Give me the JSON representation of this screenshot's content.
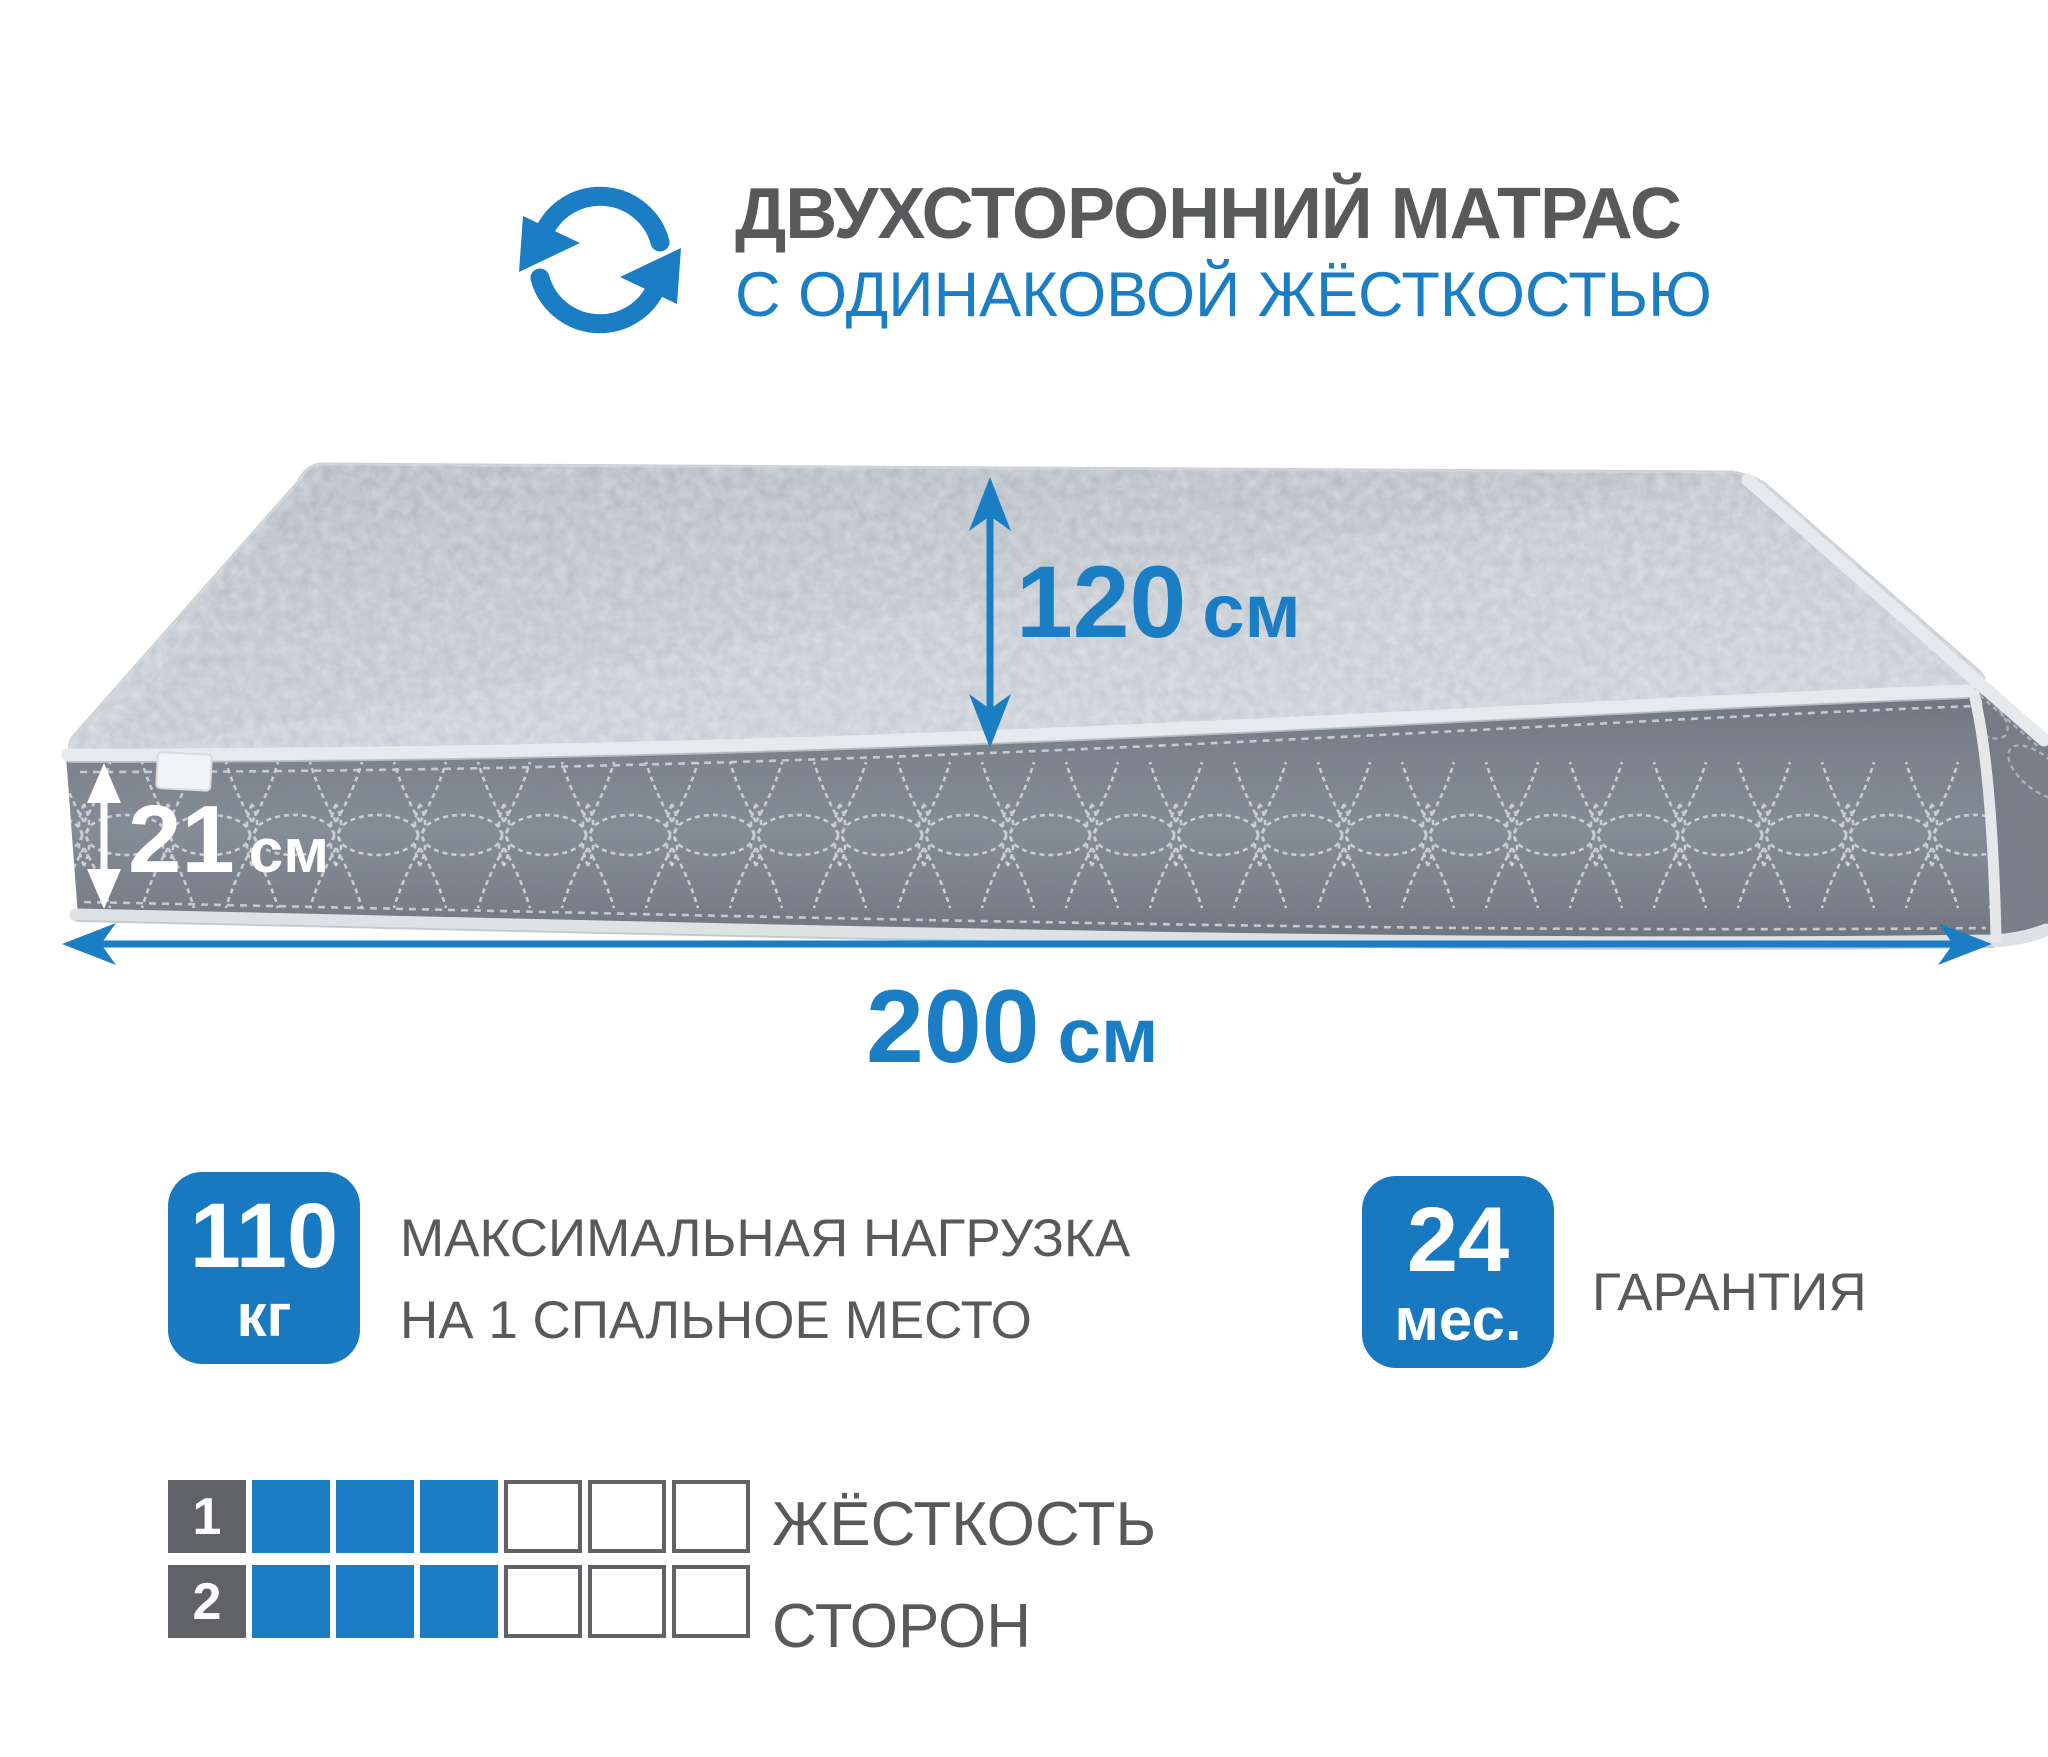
{
  "header": {
    "title_line1": "ДВУХСТОРОННИЙ МАТРАС",
    "title_line2": "С ОДИНАКОВОЙ ЖЁСТКОСТЬЮ",
    "icon": "rotate-arrows-icon"
  },
  "mattress": {
    "depth": {
      "value": "120",
      "unit": "см"
    },
    "thickness": {
      "value": "21",
      "unit": "см"
    },
    "length": {
      "value": "200",
      "unit": "см"
    }
  },
  "features": {
    "max_load": {
      "value": "110",
      "unit": "кг",
      "label_line1": "МАКСИМАЛЬНАЯ НАГРУЗКА",
      "label_line2": "НА 1 СПАЛЬНОЕ МЕСТО"
    },
    "warranty": {
      "value": "24",
      "unit": "мес.",
      "label": "ГАРАНТИЯ"
    }
  },
  "hardness": {
    "label_line1": "ЖЁСТКОСТЬ",
    "label_line2": "СТОРОН",
    "scale_max": 6,
    "rows": [
      {
        "side_number": "1",
        "filled": 3
      },
      {
        "side_number": "2",
        "filled": 3
      }
    ]
  },
  "colors": {
    "accent_blue": "#1b7ec5",
    "badge_blue": "#1878c0",
    "text_gray": "#58595b",
    "tile_gray": "#606266",
    "top_fabric": "#c3c9d0",
    "side_fabric": "#7b828c"
  }
}
